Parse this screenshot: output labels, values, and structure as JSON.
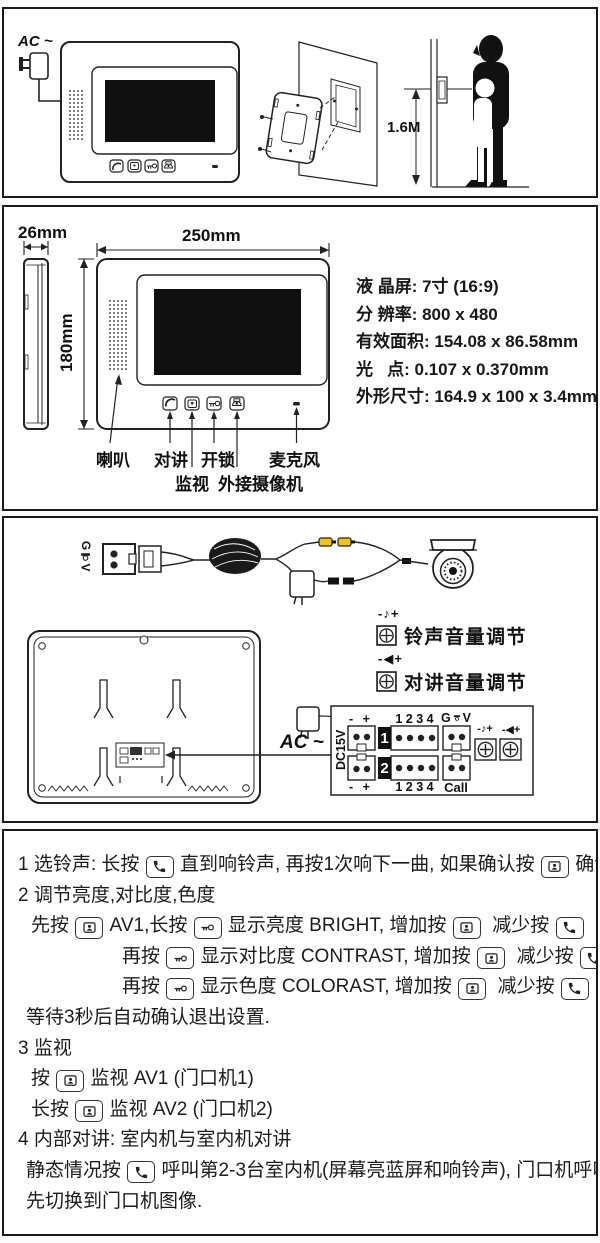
{
  "panel1": {
    "ac_label": "AC ~",
    "mount_height": "1.6M"
  },
  "panel2": {
    "depth": "26mm",
    "width": "250mm",
    "height": "180mm",
    "specs": [
      "液 晶屏: 7寸 (16:9)",
      "分 辨率: 800 x 480",
      "有效面积: 154.08 x 86.58mm",
      "光   点: 0.107 x 0.370mm",
      "外形尺寸: 164.9 x 100 x 3.4mm"
    ],
    "labels": {
      "speaker": "喇叭",
      "talk": "对讲",
      "monitor": "监视",
      "unlock": "开锁",
      "ext_camera": "外接摄像机",
      "mic": "麦克风"
    }
  },
  "panel3": {
    "connector_g": "G",
    "connector_v": "V",
    "ring_volume_symbol": "-♪+",
    "ring_volume_label": "铃声音量调节",
    "talk_volume_symbol": "-◀+",
    "talk_volume_label": "对讲音量调节",
    "ac_label": "AC ~",
    "dc_label": "DC15V",
    "row1_pins": "- +",
    "row1_num": "1",
    "row1_pins4": "1 2 3 4",
    "gv_g": "G",
    "gv_v": "V",
    "row2_pins": "- +",
    "row2_num": "2",
    "row2_pins4": "1 2 3 4",
    "call_label": "Call"
  },
  "instructions": {
    "lines": [
      {
        "indent": 14,
        "segments": [
          {
            "t": "1 选铃声: 长按 "
          },
          {
            "i": "phone"
          },
          {
            "t": " 直到响铃声, 再按1次响下一曲, 如果确认按 "
          },
          {
            "i": "monitor"
          },
          {
            "t": " 确认退出."
          }
        ]
      },
      {
        "indent": 14,
        "segments": [
          {
            "t": "2 调节亮度,对比度,色度"
          }
        ]
      },
      {
        "indent": 27,
        "segments": [
          {
            "t": "先按 "
          },
          {
            "i": "monitor"
          },
          {
            "t": " AV1,长按 "
          },
          {
            "i": "key"
          },
          {
            "t": " 显示亮度 BRIGHT, 增加按 "
          },
          {
            "i": "monitor"
          },
          {
            "t": "  减少按 "
          },
          {
            "i": "phone"
          }
        ]
      },
      {
        "indent": 118,
        "segments": [
          {
            "t": "再按 "
          },
          {
            "i": "key"
          },
          {
            "t": " 显示对比度 CONTRAST, 增加按 "
          },
          {
            "i": "monitor"
          },
          {
            "t": "  减少按 "
          },
          {
            "i": "phone"
          }
        ]
      },
      {
        "indent": 118,
        "segments": [
          {
            "t": "再按 "
          },
          {
            "i": "key"
          },
          {
            "t": " 显示色度 COLORAST, 增加按 "
          },
          {
            "i": "monitor"
          },
          {
            "t": "  减少按 "
          },
          {
            "i": "phone"
          }
        ]
      },
      {
        "indent": 22,
        "segments": [
          {
            "t": "等待3秒后自动确认退出设置."
          }
        ]
      },
      {
        "indent": 14,
        "segments": [
          {
            "t": "3 监视"
          }
        ]
      },
      {
        "indent": 27,
        "segments": [
          {
            "t": "按 "
          },
          {
            "i": "monitor"
          },
          {
            "t": " 监视 AV1 (门口机1)"
          }
        ]
      },
      {
        "indent": 27,
        "segments": [
          {
            "t": "长按 "
          },
          {
            "i": "monitor"
          },
          {
            "t": " 监视 AV2 (门口机2)"
          }
        ]
      },
      {
        "indent": 14,
        "segments": [
          {
            "t": "4 内部对讲: 室内机与室内机对讲"
          }
        ]
      },
      {
        "indent": 22,
        "segments": [
          {
            "t": "静态情况按 "
          },
          {
            "i": "phone"
          },
          {
            "t": " 呼叫第2-3台室内机(屏幕亮蓝屏和响铃声), 门口机呼叫会优"
          }
        ]
      },
      {
        "indent": 22,
        "segments": [
          {
            "t": "先切换到门口机图像."
          }
        ]
      }
    ]
  }
}
